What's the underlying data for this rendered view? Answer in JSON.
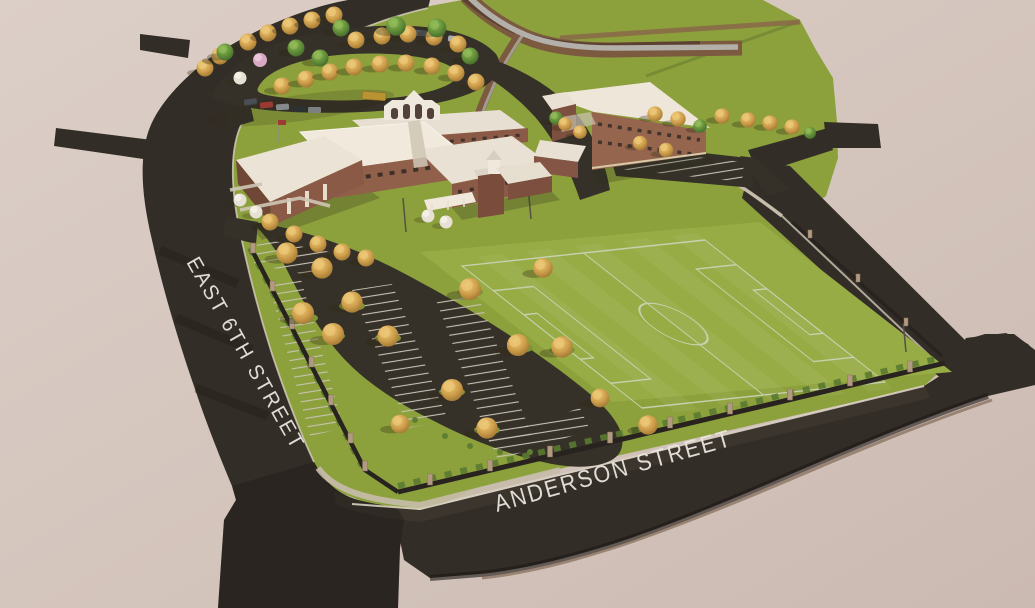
{
  "street_labels": {
    "east_6th": "EAST 6TH STREET",
    "anderson": "ANDERSON STREET"
  },
  "colors": {
    "background": "#d4c5bd",
    "road": "#332d27",
    "grass": "#8ca13c",
    "field": "#98ac45",
    "field_lines": "#cdd5bb",
    "parking_asphalt": "#353028",
    "stall_lines": "#c8c2b4",
    "tree_gold": "#cf9f4c",
    "tree_green": "#5f8c38",
    "roof_white": "#efe8db",
    "brick": "#8a5a46",
    "creek_water": "#b3b0aa",
    "creek_bank": "#7b5a40",
    "sidewalk": "#c6bcab",
    "curb_line": "#d8d0c2",
    "fence": "#28231f",
    "pillar": "#b29a80",
    "label_text": "#e9e5df"
  }
}
